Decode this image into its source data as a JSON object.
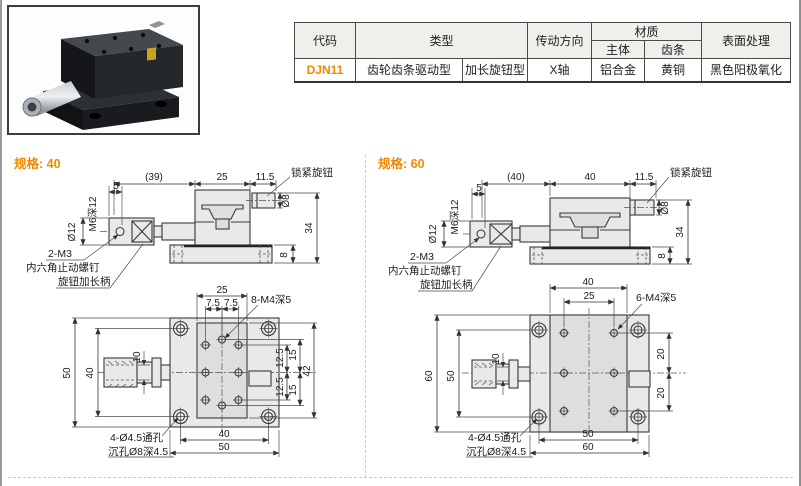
{
  "table": {
    "headers": {
      "code": "代码",
      "type": "类型",
      "direction": "传动方向",
      "material": "材质",
      "body": "主体",
      "rack": "齿条",
      "surface": "表面处理"
    },
    "row": {
      "code": "DJN11",
      "type_main": "齿轮齿条驱动型",
      "type_sub": "加长旋钮型",
      "direction": "X轴",
      "body": "铝合金",
      "rack": "黄铜",
      "surface": "黑色阳极氧化"
    }
  },
  "colors": {
    "accent": "#ef8a00"
  },
  "labels": {
    "lock_knob": "锁紧旋钮",
    "set_screw_qty": "2-M3",
    "set_screw_name": "内六角止动螺钉",
    "handle_name": "旋钮加长柄",
    "m6": "M6深12",
    "five": "5",
    "d12": "Ø12",
    "d8": "Ø8",
    "h34": "34",
    "h8": "8",
    "ten": "10",
    "hole_note1": "4-Ø4.5通孔",
    "hole_note2": "沉孔Ø8深4.5"
  },
  "spec40": {
    "title": "规格: 40",
    "side": {
      "total": "(39)",
      "body": "25",
      "knob": "11.5"
    },
    "front": {
      "top_w": "25",
      "p75a": "7.5",
      "p75b": "7.5",
      "holes": "8-M4深5",
      "outer": "50",
      "inner": "40",
      "r125a": "12.5",
      "r15a": "15",
      "r125b": "12.5",
      "r15b": "15",
      "r42": "42",
      "bot_inner": "40",
      "bot_outer": "50"
    }
  },
  "spec60": {
    "title": "规格: 60",
    "side": {
      "total": "(40)",
      "body": "40",
      "knob": "11.5"
    },
    "front": {
      "top_w": "40",
      "top_inner": "25",
      "holes": "6-M4深5",
      "outer": "60",
      "inner": "50",
      "r20a": "20",
      "r20b": "20",
      "bot_inner": "50",
      "bot_outer": "60"
    }
  }
}
